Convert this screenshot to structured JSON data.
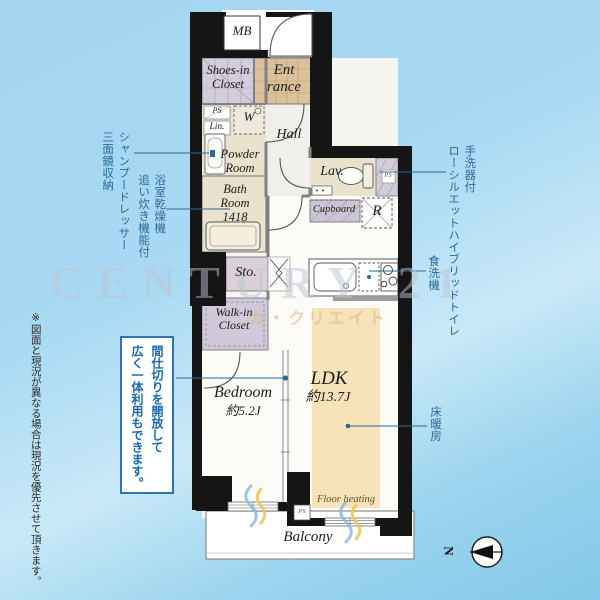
{
  "rooms": {
    "mb": "MB",
    "shoes_in_closet": "Shoes-in\nCloset",
    "entrance": "Ent\nrance",
    "ps_top": "PS",
    "linen": "Lin.",
    "washer": "W",
    "powder_room": "Powder\nRoom",
    "hall": "Hall",
    "lavatory": "Lav.",
    "ps_lav": "PS",
    "bath_room": "Bath\nRoom\n1418",
    "cupboard": "Cupboard",
    "refrigerator": "R",
    "storage": "Sto.",
    "walk_in_closet": "Walk-in\nCloset",
    "bedroom": "Bedroom",
    "bedroom_size": "約5.2J",
    "ldk": "LDK",
    "ldk_size": "約13.7J",
    "floor_heating": "Floor heating",
    "balcony": "Balcony",
    "ps_balcony": "PS"
  },
  "annotations": {
    "shampoo_dresser": "シャンプードレッサー\n三面鏡収納",
    "bath_dryer": "浴室乾燥機\n追い炊き機能付",
    "toilet": "手洗器付\nローシルエットハイブリッドトイレ",
    "dishwasher": "食洗機",
    "floor_heating": "床暖房",
    "partition_note": "間仕切りを開放して\n広く一体利用もできます。",
    "disclaimer": "※図面と現況が異なる場合は現況を優先させて頂きます。"
  },
  "compass": {
    "north": "N"
  },
  "watermark": {
    "latin": "CENTURY 21",
    "katakana": "カ・クリエイト"
  },
  "colors": {
    "annotation_blue": "#2b6a96",
    "note_blue": "#1668b3",
    "wall_black": "#151515",
    "tatami_beige": "#e9e2cd",
    "entrance_tile": "#dac19a",
    "closet_lavender": "#d2ccdc",
    "floor_heating_orange": "#f7e3ba",
    "background_sky": "#a3d5f1"
  }
}
